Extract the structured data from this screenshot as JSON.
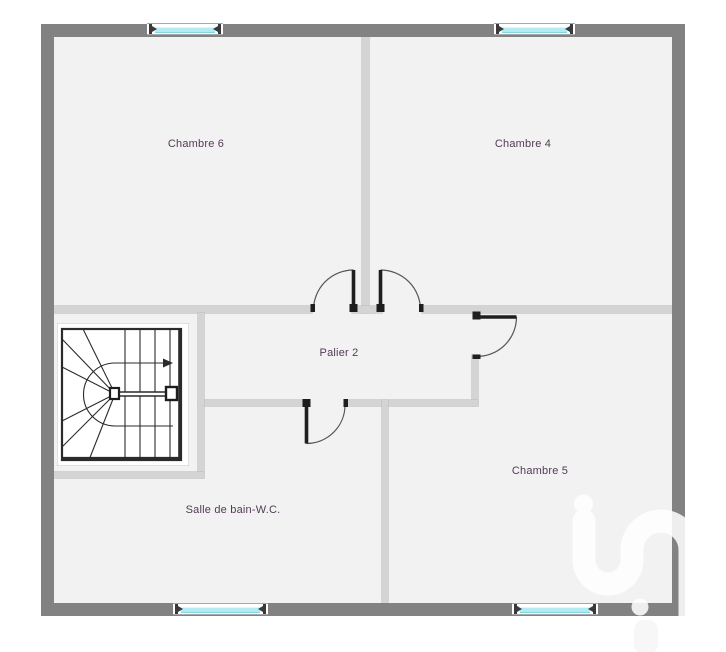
{
  "plan_title": "Floor plan - upper storey",
  "rooms": [
    {
      "name": "chambre-6",
      "label": "Chambre 6"
    },
    {
      "name": "chambre-4",
      "label": "Chambre 4"
    },
    {
      "name": "palier",
      "label": "Palier 2"
    },
    {
      "name": "chambre-5",
      "label": "Chambre 5"
    },
    {
      "name": "salle-de-bain",
      "label": "Salle de bain-W.C."
    }
  ],
  "colors": {
    "exterior_wall": "#828282",
    "interior_wall": "#d4d4d4",
    "floor": "#f2f2f2",
    "window_glass": "#b2ecf2",
    "door_leaf": "#222222",
    "stair_lines": "#2b2b2b",
    "label_text": "#533a56",
    "watermark": "#ffffff"
  }
}
